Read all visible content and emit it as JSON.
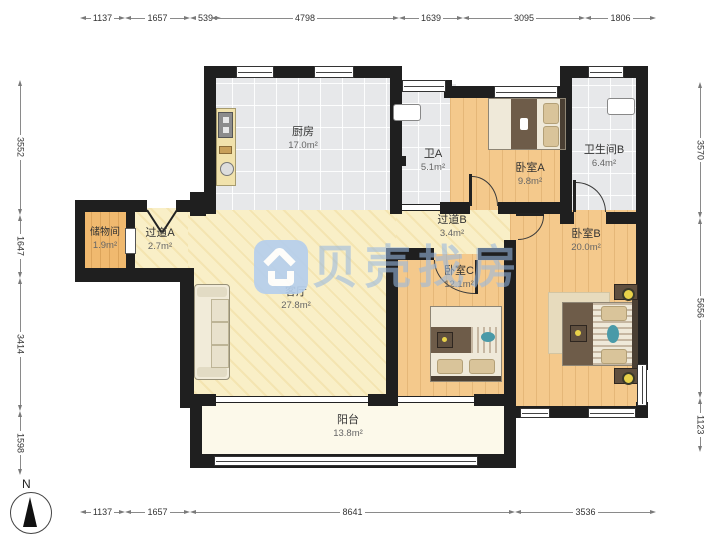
{
  "watermark": {
    "brand": "贝壳找房"
  },
  "compass": {
    "label": "N"
  },
  "rooms": {
    "kitchen": {
      "name": "厨房",
      "area": "17.0m²"
    },
    "bath_a": {
      "name": "卫A",
      "area": "5.1m²"
    },
    "bedroom_a": {
      "name": "卧室A",
      "area": "9.8m²"
    },
    "bath_b": {
      "name": "卫生间B",
      "area": "6.4m²"
    },
    "storage": {
      "name": "储物间",
      "area": "1.9m²"
    },
    "hall_a": {
      "name": "过道A",
      "area": "2.7m²"
    },
    "hall_b": {
      "name": "过道B",
      "area": "3.4m²"
    },
    "living": {
      "name": "客厅",
      "area": "27.8m²"
    },
    "bedroom_c": {
      "name": "卧室C",
      "area": "12.1m²"
    },
    "bedroom_b": {
      "name": "卧室B",
      "area": "20.0m²"
    },
    "balcony": {
      "name": "阳台",
      "area": "13.8m²"
    }
  },
  "dimensions": {
    "top": [
      "1137",
      "1657",
      "539",
      "4798",
      "1639",
      "3095",
      "1806"
    ],
    "bottom": [
      "1137",
      "1657",
      "8641",
      "3536"
    ],
    "left": [
      "3552",
      "1647",
      "3414",
      "1598"
    ],
    "right": [
      "3570",
      "5656",
      "1123"
    ]
  },
  "colors": {
    "wall": "#1f1f1f",
    "tile_floor": "#e7e8ea",
    "wood_floor": "#f4c98c",
    "living_floor": "#f9efc7",
    "balcony_floor": "#fcf9ea",
    "watermark_blue": "#b6cfec"
  }
}
